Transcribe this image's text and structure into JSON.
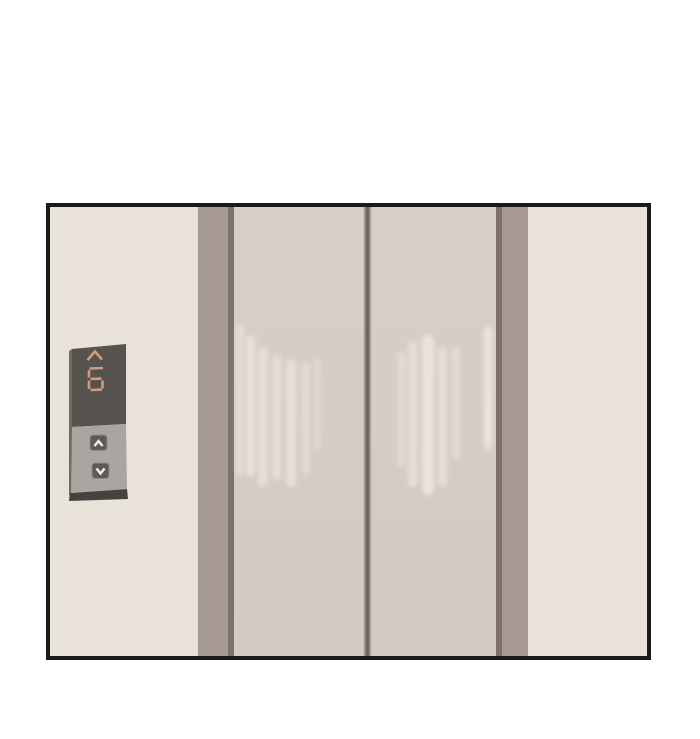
{
  "scene": {
    "subject": "elevator-lobby-with-closed-doors",
    "style": "flat-webtoon-panel-on-white"
  },
  "elevator": {
    "floor_display": {
      "current_floor": "6",
      "direction": "up",
      "display_style": "seven-segment"
    },
    "call_panel": {
      "buttons": [
        {
          "name": "call-up-button",
          "glyph": "chevron-up"
        },
        {
          "name": "call-down-button",
          "glyph": "chevron-down"
        }
      ]
    },
    "doors": {
      "state": "closed",
      "count": "2"
    }
  },
  "colors": {
    "page_background": "#ffffff",
    "frame_border": "#1b1a18",
    "wall": "#e9e2d8",
    "pillar": "#a69a92",
    "pillar_edge": "#7c716b",
    "door": "#d6cec5",
    "door_seam": "#6e655f",
    "door_highlight_streak": "#efe9e2",
    "panel_display_bg": "#56524e",
    "panel_button_section_bg": "#a9a5a1",
    "panel_depth_side": "#45413e",
    "segment_glyph": "#d49a80",
    "button_face": "#5e5a57",
    "button_glyph": "#f4f2ef"
  }
}
